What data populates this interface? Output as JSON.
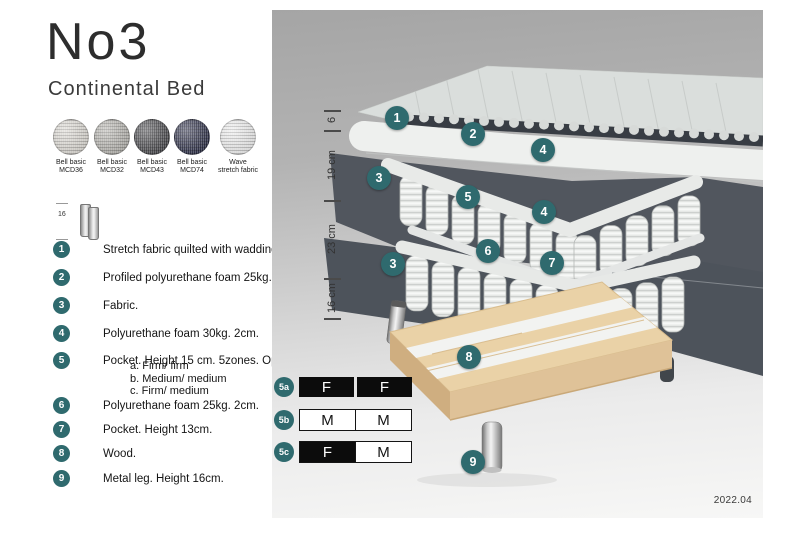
{
  "page": {
    "title": "No3",
    "subtitle": "Continental Bed"
  },
  "swatches": [
    {
      "line1": "Bell basic",
      "line2": "MCD36",
      "color": "#d8d5cf"
    },
    {
      "line1": "Bell basic",
      "line2": "MCD32",
      "color": "#b2b0ab"
    },
    {
      "line1": "Bell basic",
      "line2": "MCD43",
      "color": "#4a4a4d"
    },
    {
      "line1": "Bell basic",
      "line2": "MCD74",
      "color": "#2f3149"
    },
    {
      "line1": "Wave",
      "line2": "stretch fabric",
      "color": "#eaeaea"
    }
  ],
  "leg_thumbnail": {
    "dimension_label": "16"
  },
  "spec_items": [
    {
      "num": "1",
      "text": "Stretch fabric quilted with wadding."
    },
    {
      "num": "2",
      "text": "Profiled polyurethane foam 25kg. 4cm."
    },
    {
      "num": "3",
      "text": "Fabric."
    },
    {
      "num": "4",
      "text": "Polyurethane foam 30kg. 2cm."
    },
    {
      "num": "5",
      "text": "Pocket. Height 15 cm. 5zones. Option:",
      "options": [
        "a. Firm/ firm",
        "b. Medium/ medium",
        "c. Firm/ medium"
      ]
    },
    {
      "num": "6",
      "text": "Polyurethane foam 25kg. 2cm."
    },
    {
      "num": "7",
      "text": "Pocket. Height 13cm."
    },
    {
      "num": "8",
      "text": "Wood."
    },
    {
      "num": "9",
      "text": "Metal leg. Height 16cm."
    }
  ],
  "diagram": {
    "dimension_labels": [
      "6",
      "19 cm",
      "23 cm",
      "16 cm"
    ],
    "callouts": [
      {
        "label": "1"
      },
      {
        "label": "2"
      },
      {
        "label": "4"
      },
      {
        "label": "3"
      },
      {
        "label": "5"
      },
      {
        "label": "4"
      },
      {
        "label": "6"
      },
      {
        "label": "7"
      },
      {
        "label": "3"
      },
      {
        "label": "8"
      },
      {
        "label": "9"
      }
    ],
    "firmness_options": [
      {
        "id": "5a",
        "cells": [
          {
            "label": "F",
            "filled": true
          },
          {
            "label": "F",
            "filled": true
          }
        ]
      },
      {
        "id": "5b",
        "cells": [
          {
            "label": "M",
            "filled": false
          },
          {
            "label": "M",
            "filled": false
          }
        ]
      },
      {
        "id": "5c",
        "cells": [
          {
            "label": "F",
            "filled": true
          },
          {
            "label": "M",
            "filled": false
          }
        ]
      }
    ],
    "date": "2022.04"
  },
  "colors": {
    "accent_teal": "#2f6a6e",
    "panel_gray_top": "#a5a5a5",
    "panel_gray_bottom": "#f7f7f6",
    "fabric_dark": "#51565e",
    "wood": "#ead2a7",
    "firmness_black": "#0c0c0c"
  }
}
